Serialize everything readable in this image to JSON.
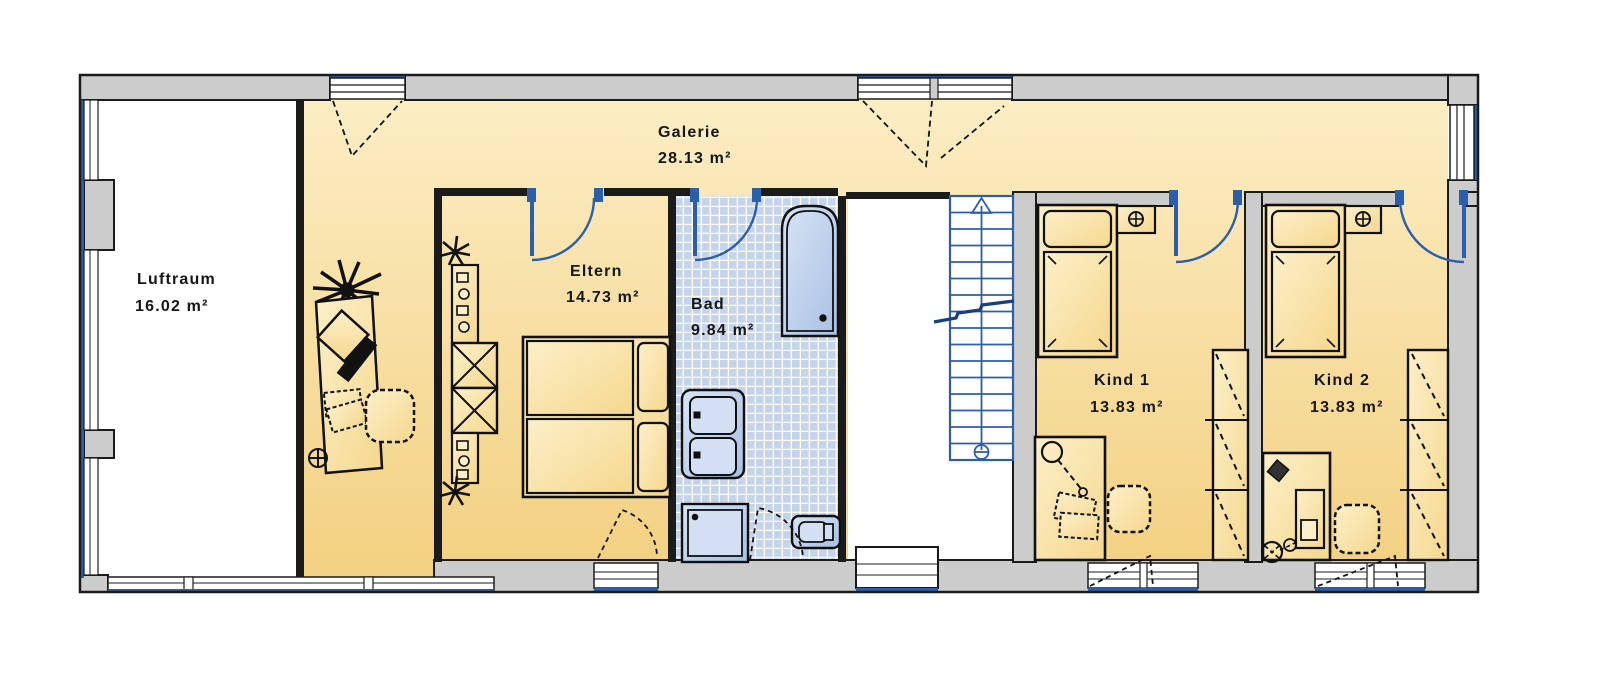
{
  "rooms": [
    {
      "id": "galerie",
      "name": "Galerie",
      "area": "28.13 m²"
    },
    {
      "id": "luftraum",
      "name": "Luftraum",
      "area": "16.02 m²"
    },
    {
      "id": "eltern",
      "name": "Eltern",
      "area": "14.73 m²"
    },
    {
      "id": "bad",
      "name": "Bad",
      "area": "9.84 m²"
    },
    {
      "id": "kind1",
      "name": "Kind 1",
      "area": "13.83 m²"
    },
    {
      "id": "kind2",
      "name": "Kind 2",
      "area": "13.83 m²"
    }
  ],
  "colors": {
    "floor_yellow": "#F5D78F",
    "floor_light": "#FCEDC4",
    "wall_gray": "#CCCCCC",
    "outline_black": "#1B1B1B",
    "fixture_blue": "#2B5FAC",
    "stair_blue": "#2B5FAC",
    "tile_blue": "#C6D4EB",
    "sanitary_fill": "#B9CCE9"
  }
}
